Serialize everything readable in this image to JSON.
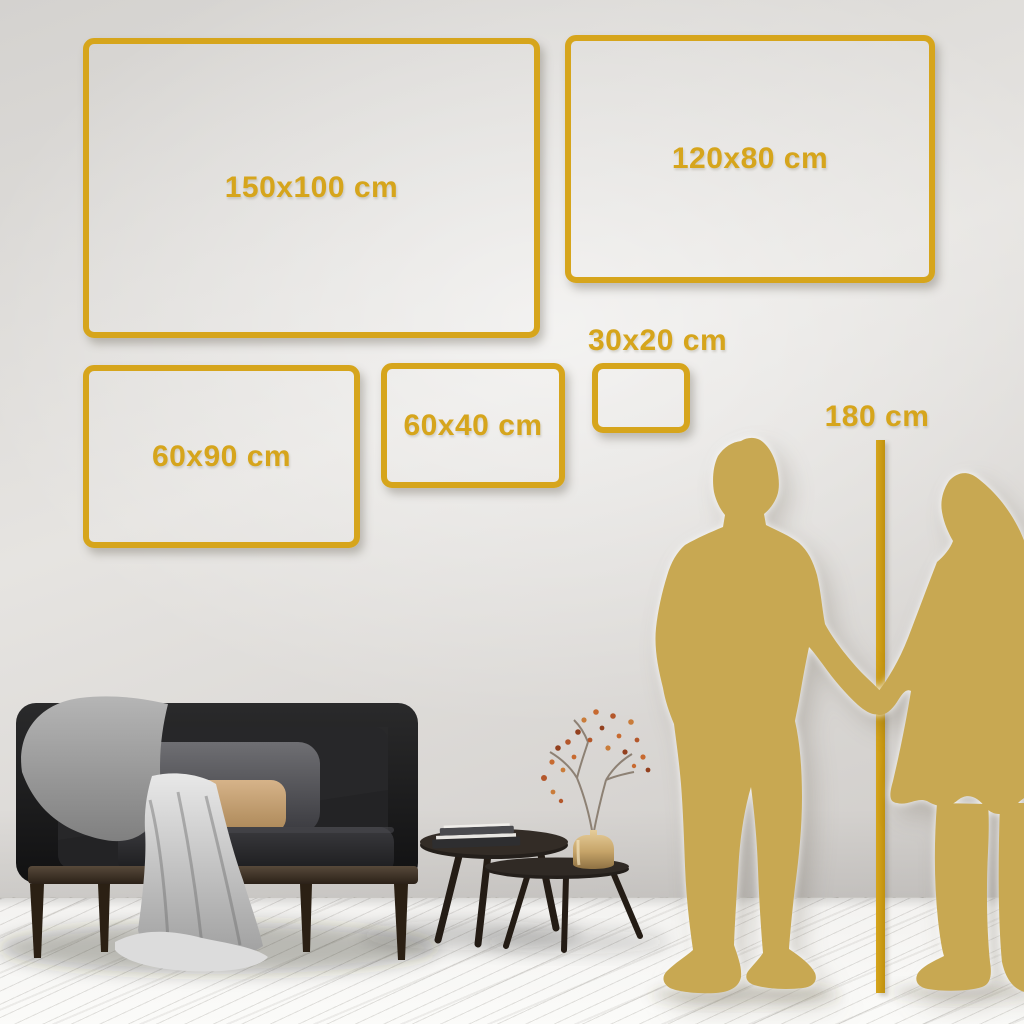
{
  "page": {
    "type": "product-size-guide",
    "description": "Canvas print size comparison on a living room wall with couple silhouettes for scale"
  },
  "size_frames": [
    {
      "id": "150x100",
      "label": "150x100 cm"
    },
    {
      "id": "120x80",
      "label": "120x80 cm"
    },
    {
      "id": "60x90",
      "label": "60x90 cm"
    },
    {
      "id": "60x40",
      "label": "60x40 cm"
    },
    {
      "id": "30x20",
      "label": "30x20 cm"
    }
  ],
  "height_marker": {
    "label": "180 cm"
  },
  "colors": {
    "accent_gold": "#D6A51C",
    "silhouette_gold": "#C8A852",
    "wall_light": "#E6E4E1",
    "wall_dark": "#CFCCC9",
    "floor": "#F3F2F0",
    "sofa_dark": "#1C1C1D",
    "pillow_gray": "#55555A",
    "pillow_tan": "#C9A87B",
    "blanket_gray": "#B9B9B9",
    "wood_dark": "#32281E",
    "brass": "#C6A469",
    "blossom_rust": "#B4572B"
  }
}
